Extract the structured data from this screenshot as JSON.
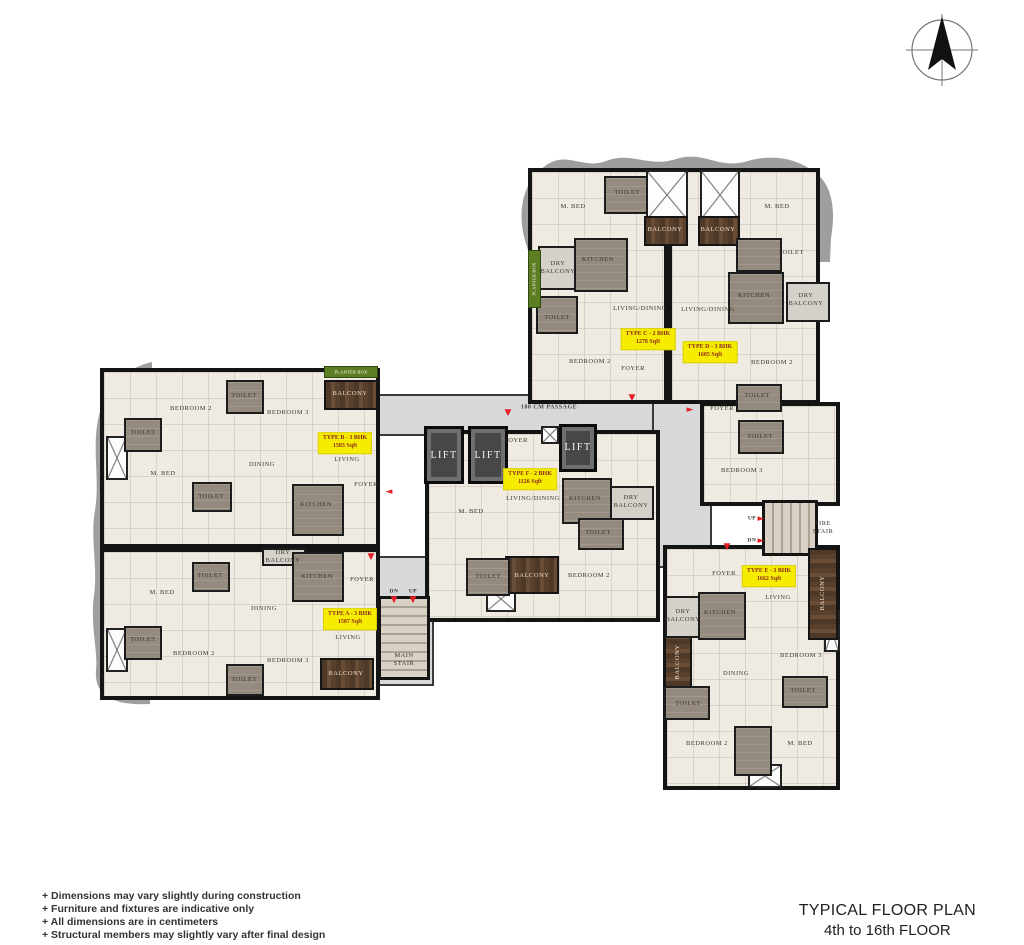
{
  "title": {
    "line1": "TYPICAL FLOOR PLAN",
    "line2": "4th to 16th FLOOR"
  },
  "notes": [
    "+  Dimensions may vary slightly during construction",
    "+  Furniture and fixtures are indicative only",
    "+  All dimensions are in centimeters",
    "+  Structural members may slightly vary after final design"
  ],
  "compass": {
    "name": "north-arrow"
  },
  "units": [
    {
      "type": "TYPE A - 3 BHK",
      "area_sqft": "1587 Sqft"
    },
    {
      "type": "TYPE B - 3 BHK",
      "area_sqft": "1583 Sqft"
    },
    {
      "type": "TYPE C - 2 BHK",
      "area_sqft": "1278 Sqft"
    },
    {
      "type": "TYPE D - 3 BHK",
      "area_sqft": "1605 Sqft"
    },
    {
      "type": "TYPE E - 3 BHK",
      "area_sqft": "1662 Sqft"
    },
    {
      "type": "TYPE F - 2 BHK",
      "area_sqft": "1126 Sqft"
    }
  ],
  "plan": {
    "areas": [
      {
        "name": "passage-corridor",
        "cls": "corridor",
        "x": 376,
        "y": 394,
        "w": 292,
        "h": 42
      },
      {
        "name": "east-corridor",
        "cls": "corridor",
        "x": 652,
        "y": 400,
        "w": 60,
        "h": 168
      },
      {
        "name": "stair-corridor",
        "cls": "corridor",
        "x": 374,
        "y": 556,
        "w": 60,
        "h": 130
      },
      {
        "name": "unit-c-base",
        "cls": "base",
        "x": 528,
        "y": 168,
        "w": 140,
        "h": 236
      },
      {
        "name": "unit-d-base",
        "cls": "base",
        "x": 668,
        "y": 168,
        "w": 152,
        "h": 236
      },
      {
        "name": "unit-d-lower",
        "cls": "base",
        "x": 700,
        "y": 402,
        "w": 140,
        "h": 104
      },
      {
        "name": "unit-b-base",
        "cls": "base",
        "x": 100,
        "y": 368,
        "w": 280,
        "h": 180
      },
      {
        "name": "unit-a-base",
        "cls": "base",
        "x": 100,
        "y": 548,
        "w": 280,
        "h": 152
      },
      {
        "name": "unit-f-base",
        "cls": "base",
        "x": 425,
        "y": 430,
        "w": 235,
        "h": 192
      },
      {
        "name": "unit-e-base",
        "cls": "base",
        "x": 663,
        "y": 545,
        "w": 177,
        "h": 245
      },
      {
        "name": "main-stair",
        "cls": "stair-h",
        "x": 378,
        "y": 596,
        "w": 52,
        "h": 84
      },
      {
        "name": "fire-stair",
        "cls": "stair-v",
        "x": 762,
        "y": 500,
        "w": 56,
        "h": 56
      },
      {
        "name": "lift-1",
        "cls": "lift",
        "x": 424,
        "y": 426,
        "w": 40,
        "h": 58
      },
      {
        "name": "lift-2",
        "cls": "lift",
        "x": 468,
        "y": 426,
        "w": 40,
        "h": 58
      },
      {
        "name": "lift-3",
        "cls": "lift",
        "x": 559,
        "y": 424,
        "w": 38,
        "h": 48
      },
      {
        "name": "shaft",
        "cls": "shaft",
        "x": 646,
        "y": 170,
        "w": 42,
        "h": 50
      },
      {
        "name": "shaft",
        "cls": "shaft",
        "x": 700,
        "y": 170,
        "w": 40,
        "h": 50
      },
      {
        "name": "shaft",
        "cls": "shaft",
        "x": 541,
        "y": 426,
        "w": 18,
        "h": 18
      },
      {
        "name": "shaft",
        "cls": "shaft",
        "x": 106,
        "y": 436,
        "w": 22,
        "h": 44
      },
      {
        "name": "shaft",
        "cls": "shaft",
        "x": 106,
        "y": 628,
        "w": 22,
        "h": 44
      },
      {
        "name": "shaft",
        "cls": "shaft",
        "x": 486,
        "y": 586,
        "w": 30,
        "h": 26
      },
      {
        "name": "shaft",
        "cls": "shaft",
        "x": 824,
        "y": 610,
        "w": 16,
        "h": 42
      },
      {
        "name": "shaft",
        "cls": "shaft",
        "x": 748,
        "y": 764,
        "w": 34,
        "h": 24
      },
      {
        "name": "balcony-b",
        "cls": "balcony-v",
        "x": 324,
        "y": 380,
        "w": 54,
        "h": 30
      },
      {
        "name": "balcony-a",
        "cls": "balcony-v",
        "x": 320,
        "y": 658,
        "w": 54,
        "h": 32
      },
      {
        "name": "balcony-f",
        "cls": "balcony-v",
        "x": 505,
        "y": 556,
        "w": 54,
        "h": 38
      },
      {
        "name": "balcony-c-top",
        "cls": "balcony-v",
        "x": 644,
        "y": 216,
        "w": 44,
        "h": 30
      },
      {
        "name": "balcony-d-top",
        "cls": "balcony-v",
        "x": 698,
        "y": 216,
        "w": 42,
        "h": 30
      },
      {
        "name": "balcony-e-right",
        "cls": "balcony-h",
        "x": 808,
        "y": 548,
        "w": 30,
        "h": 92
      },
      {
        "name": "balcony-e-left",
        "cls": "balcony-h",
        "x": 664,
        "y": 636,
        "w": 28,
        "h": 52
      },
      {
        "name": "planter-box-b",
        "cls": "planter",
        "x": 324,
        "y": 366,
        "w": 54,
        "h": 12
      },
      {
        "name": "planter-box-c",
        "cls": "planter",
        "x": 528,
        "y": 250,
        "w": 13,
        "h": 58
      },
      {
        "name": "dry-balcony-c",
        "cls": "dry",
        "x": 538,
        "y": 246,
        "w": 40,
        "h": 44
      },
      {
        "name": "dry-balcony-d",
        "cls": "dry",
        "x": 786,
        "y": 282,
        "w": 44,
        "h": 40
      },
      {
        "name": "dry-balcony-f",
        "cls": "dry",
        "x": 608,
        "y": 486,
        "w": 46,
        "h": 34
      },
      {
        "name": "dry-balcony-e",
        "cls": "dry",
        "x": 665,
        "y": 596,
        "w": 40,
        "h": 42
      },
      {
        "name": "dry-balcony-a",
        "cls": "dry",
        "x": 262,
        "y": 548,
        "w": 44,
        "h": 18
      },
      {
        "name": "toilet",
        "cls": "wet",
        "x": 226,
        "y": 380,
        "w": 38,
        "h": 34
      },
      {
        "name": "toilet",
        "cls": "wet",
        "x": 124,
        "y": 418,
        "w": 38,
        "h": 34
      },
      {
        "name": "toilet",
        "cls": "wet",
        "x": 192,
        "y": 482,
        "w": 40,
        "h": 30
      },
      {
        "name": "kitchen",
        "cls": "wet",
        "x": 292,
        "y": 484,
        "w": 52,
        "h": 52
      },
      {
        "name": "toilet",
        "cls": "wet",
        "x": 192,
        "y": 562,
        "w": 38,
        "h": 30
      },
      {
        "name": "toilet",
        "cls": "wet",
        "x": 124,
        "y": 626,
        "w": 38,
        "h": 34
      },
      {
        "name": "toilet",
        "cls": "wet",
        "x": 226,
        "y": 664,
        "w": 38,
        "h": 32
      },
      {
        "name": "kitchen",
        "cls": "wet",
        "x": 292,
        "y": 552,
        "w": 52,
        "h": 50
      },
      {
        "name": "toilet",
        "cls": "wet",
        "x": 604,
        "y": 176,
        "w": 44,
        "h": 38
      },
      {
        "name": "kitchen",
        "cls": "wet",
        "x": 574,
        "y": 238,
        "w": 54,
        "h": 54
      },
      {
        "name": "toilet",
        "cls": "wet",
        "x": 536,
        "y": 296,
        "w": 42,
        "h": 38
      },
      {
        "name": "toilet",
        "cls": "wet",
        "x": 736,
        "y": 238,
        "w": 46,
        "h": 34
      },
      {
        "name": "kitchen",
        "cls": "wet",
        "x": 728,
        "y": 272,
        "w": 56,
        "h": 52
      },
      {
        "name": "toilet",
        "cls": "wet",
        "x": 736,
        "y": 384,
        "w": 46,
        "h": 28
      },
      {
        "name": "toilet",
        "cls": "wet",
        "x": 738,
        "y": 420,
        "w": 46,
        "h": 34
      },
      {
        "name": "kitchen",
        "cls": "wet",
        "x": 562,
        "y": 478,
        "w": 50,
        "h": 46
      },
      {
        "name": "toilet",
        "cls": "wet",
        "x": 578,
        "y": 518,
        "w": 46,
        "h": 32
      },
      {
        "name": "toilet",
        "cls": "wet",
        "x": 466,
        "y": 558,
        "w": 44,
        "h": 38
      },
      {
        "name": "kitchen",
        "cls": "wet",
        "x": 698,
        "y": 592,
        "w": 48,
        "h": 48
      },
      {
        "name": "toilet",
        "cls": "wet",
        "x": 664,
        "y": 686,
        "w": 46,
        "h": 34
      },
      {
        "name": "toilet",
        "cls": "wet",
        "x": 782,
        "y": 676,
        "w": 46,
        "h": 32
      },
      {
        "name": "toilet",
        "cls": "wet",
        "x": 734,
        "y": 726,
        "w": 38,
        "h": 50
      }
    ],
    "labels": [
      {
        "t": "BEDROOM 2",
        "x": 191,
        "y": 409
      },
      {
        "t": "TOILET",
        "x": 244,
        "y": 396
      },
      {
        "t": "BEDROOM 3",
        "x": 288,
        "y": 413
      },
      {
        "t": "BALCONY",
        "x": 350,
        "y": 394,
        "c": "wood-label"
      },
      {
        "t": "TOILET",
        "x": 143,
        "y": 433
      },
      {
        "t": "M. BED",
        "x": 163,
        "y": 474
      },
      {
        "t": "DINING",
        "x": 262,
        "y": 465
      },
      {
        "t": "LIVING",
        "x": 347,
        "y": 460
      },
      {
        "t": "FOYER",
        "x": 366,
        "y": 485
      },
      {
        "t": "KITCHEN",
        "x": 316,
        "y": 505
      },
      {
        "t": "TOILET",
        "x": 211,
        "y": 497
      },
      {
        "t": "TOILET",
        "x": 210,
        "y": 576
      },
      {
        "t": "M. BED",
        "x": 162,
        "y": 593
      },
      {
        "t": "DRY\nBALCONY",
        "x": 283,
        "y": 557,
        "c": "tinylabel"
      },
      {
        "t": "KITCHEN",
        "x": 317,
        "y": 577
      },
      {
        "t": "FOYER",
        "x": 362,
        "y": 580
      },
      {
        "t": "DINING",
        "x": 264,
        "y": 609
      },
      {
        "t": "TOILET",
        "x": 143,
        "y": 640
      },
      {
        "t": "BEDROOM 2",
        "x": 194,
        "y": 654
      },
      {
        "t": "TOILET",
        "x": 244,
        "y": 680
      },
      {
        "t": "BEDROOM 3",
        "x": 288,
        "y": 661
      },
      {
        "t": "LIVING",
        "x": 348,
        "y": 638
      },
      {
        "t": "BALCONY",
        "x": 346,
        "y": 674,
        "c": "wood-label"
      },
      {
        "t": "M. BED",
        "x": 573,
        "y": 207
      },
      {
        "t": "TOILET",
        "x": 627,
        "y": 193
      },
      {
        "t": "DRY\nBALCONY",
        "x": 558,
        "y": 268
      },
      {
        "t": "KITCHEN",
        "x": 598,
        "y": 260
      },
      {
        "t": "TOILET",
        "x": 557,
        "y": 318
      },
      {
        "t": "LIVING/DINING",
        "x": 640,
        "y": 309
      },
      {
        "t": "BEDROOM 2",
        "x": 590,
        "y": 362
      },
      {
        "t": "FOYER",
        "x": 633,
        "y": 369
      },
      {
        "t": "BALCONY",
        "x": 665,
        "y": 230,
        "c": "wood-label"
      },
      {
        "t": "BALCONY",
        "x": 718,
        "y": 230,
        "c": "wood-label"
      },
      {
        "t": "M. BED",
        "x": 777,
        "y": 207
      },
      {
        "t": "TOILET",
        "x": 791,
        "y": 253
      },
      {
        "t": "KITCHEN",
        "x": 754,
        "y": 296
      },
      {
        "t": "DRY\nBALCONY",
        "x": 806,
        "y": 300
      },
      {
        "t": "LIVING/DINING",
        "x": 708,
        "y": 310
      },
      {
        "t": "BEDROOM 2",
        "x": 772,
        "y": 363
      },
      {
        "t": "TOILET",
        "x": 757,
        "y": 396
      },
      {
        "t": "FOYER",
        "x": 722,
        "y": 409
      },
      {
        "t": "TOILET",
        "x": 760,
        "y": 437
      },
      {
        "t": "BEDROOM 3",
        "x": 742,
        "y": 471
      },
      {
        "t": "FOYER",
        "x": 516,
        "y": 441
      },
      {
        "t": "LIVING/DINING",
        "x": 533,
        "y": 499
      },
      {
        "t": "M. BED",
        "x": 471,
        "y": 512
      },
      {
        "t": "KITCHEN",
        "x": 585,
        "y": 499
      },
      {
        "t": "DRY\nBALCONY",
        "x": 631,
        "y": 502
      },
      {
        "t": "TOILET",
        "x": 598,
        "y": 533
      },
      {
        "t": "TOILET",
        "x": 488,
        "y": 577
      },
      {
        "t": "BALCONY",
        "x": 532,
        "y": 576,
        "c": "wood-label"
      },
      {
        "t": "BEDROOM 2",
        "x": 589,
        "y": 576
      },
      {
        "t": "FOYER",
        "x": 724,
        "y": 574
      },
      {
        "t": "LIVING",
        "x": 778,
        "y": 598
      },
      {
        "t": "BALCONY",
        "x": 823,
        "y": 593,
        "c": "wood-label",
        "r": -90
      },
      {
        "t": "DRY\nBALCONY",
        "x": 683,
        "y": 616
      },
      {
        "t": "KITCHEN",
        "x": 720,
        "y": 613
      },
      {
        "t": "BEDROOM 3",
        "x": 801,
        "y": 656
      },
      {
        "t": "BALCONY",
        "x": 678,
        "y": 662,
        "c": "wood-label",
        "r": -90
      },
      {
        "t": "DINING",
        "x": 736,
        "y": 674
      },
      {
        "t": "TOILET",
        "x": 688,
        "y": 704
      },
      {
        "t": "TOILET",
        "x": 803,
        "y": 691
      },
      {
        "t": "BEDROOM 2",
        "x": 707,
        "y": 744
      },
      {
        "t": "M. BED",
        "x": 800,
        "y": 744
      },
      {
        "t": "LIFT",
        "x": 444,
        "y": 456,
        "c": "lift-label"
      },
      {
        "t": "LIFT",
        "x": 488,
        "y": 456,
        "c": "lift-label"
      },
      {
        "t": "LIFT",
        "x": 578,
        "y": 448,
        "c": "lift-label"
      },
      {
        "t": "180 CM PASSAGE",
        "x": 549,
        "y": 408,
        "c": "small"
      },
      {
        "t": "DN",
        "x": 394,
        "y": 592,
        "c": "tiny"
      },
      {
        "t": "UP",
        "x": 413,
        "y": 592,
        "c": "tiny"
      },
      {
        "t": "MAIN\nSTAIR",
        "x": 404,
        "y": 660
      },
      {
        "t": "FIRE\nSTAIR",
        "x": 823,
        "y": 528
      },
      {
        "t": "UP",
        "x": 752,
        "y": 519,
        "c": "tiny"
      },
      {
        "t": "DN",
        "x": 752,
        "y": 541,
        "c": "tiny"
      },
      {
        "t": "PLANTER BOX",
        "x": 351,
        "y": 372,
        "c": "planter-label"
      },
      {
        "t": "PLANTER BOX",
        "x": 534,
        "y": 279,
        "c": "planter-label",
        "r": -90
      }
    ],
    "type_labels": [
      {
        "line1": "TYPE A - 3 BHK",
        "line2": "1587 Sqft",
        "x": 350,
        "y": 619
      },
      {
        "line1": "TYPE B - 3 BHK",
        "line2": "1583 Sqft",
        "x": 345,
        "y": 443
      },
      {
        "line1": "TYPE C - 2 BHK",
        "line2": "1278 Sqft",
        "x": 648,
        "y": 339
      },
      {
        "line1": "TYPE D - 3 BHK",
        "line2": "1605 Sqft",
        "x": 710,
        "y": 352
      },
      {
        "line1": "TYPE E - 3 BHK",
        "line2": "1662 Sqft",
        "x": 769,
        "y": 576
      },
      {
        "line1": "TYPE F - 2 BHK",
        "line2": "1126 Sqft",
        "x": 530,
        "y": 479
      }
    ],
    "arrows": [
      {
        "g": "◄",
        "x": 389,
        "y": 492
      },
      {
        "g": "▼",
        "x": 371,
        "y": 557
      },
      {
        "g": "▼",
        "x": 508,
        "y": 413
      },
      {
        "g": "▼",
        "x": 632,
        "y": 398
      },
      {
        "g": "►",
        "x": 690,
        "y": 410
      },
      {
        "g": "▼",
        "x": 727,
        "y": 547
      },
      {
        "g": "▼",
        "x": 394,
        "y": 600
      },
      {
        "g": "▼",
        "x": 413,
        "y": 600
      },
      {
        "g": "►",
        "x": 761,
        "y": 519
      },
      {
        "g": "►",
        "x": 761,
        "y": 541
      }
    ]
  }
}
